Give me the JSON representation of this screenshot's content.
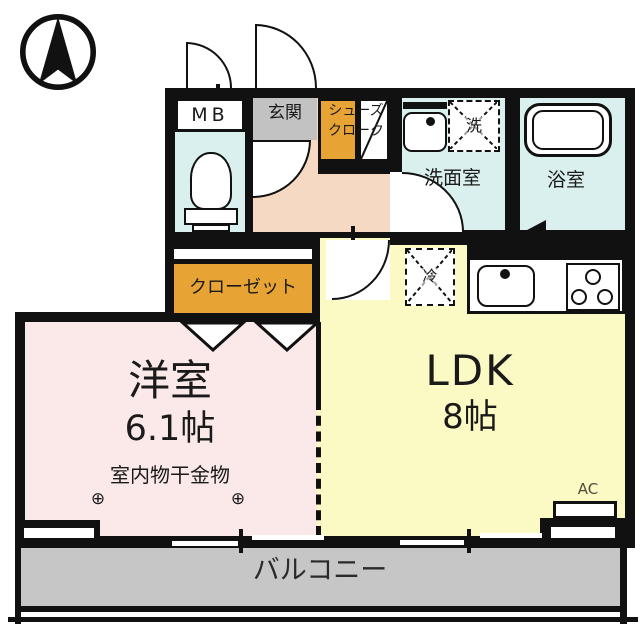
{
  "labels": {
    "mb": "MB",
    "genkan": "玄関",
    "shoe_closet_line1": "シューズ",
    "shoe_closet_line2": "クローク",
    "washroom": "洗面室",
    "washer_kanji": "洗",
    "bathroom": "浴室",
    "closet": "クローゼット",
    "fridge_kanji": "冷",
    "western_room_name": "洋室",
    "western_room_size": "6.1帖",
    "drying_hardware": "室内物干金物",
    "hook_left": "⊕",
    "hook_right": "⊕",
    "ldk_name": "LDK",
    "ldk_size": "8帖",
    "ac": "AC",
    "balcony": "バルコニー"
  },
  "colors": {
    "wall": "#111111",
    "wet_area_floor": "#d9f0ee",
    "hallway_floor": "#f6d9c2",
    "entrance_tile": "#c2c2c2",
    "storage_accent": "#e7a435",
    "western_room_floor": "#fae9e8",
    "ldk_floor": "#fbf9c4",
    "balcony_floor": "#c6c6c6"
  }
}
